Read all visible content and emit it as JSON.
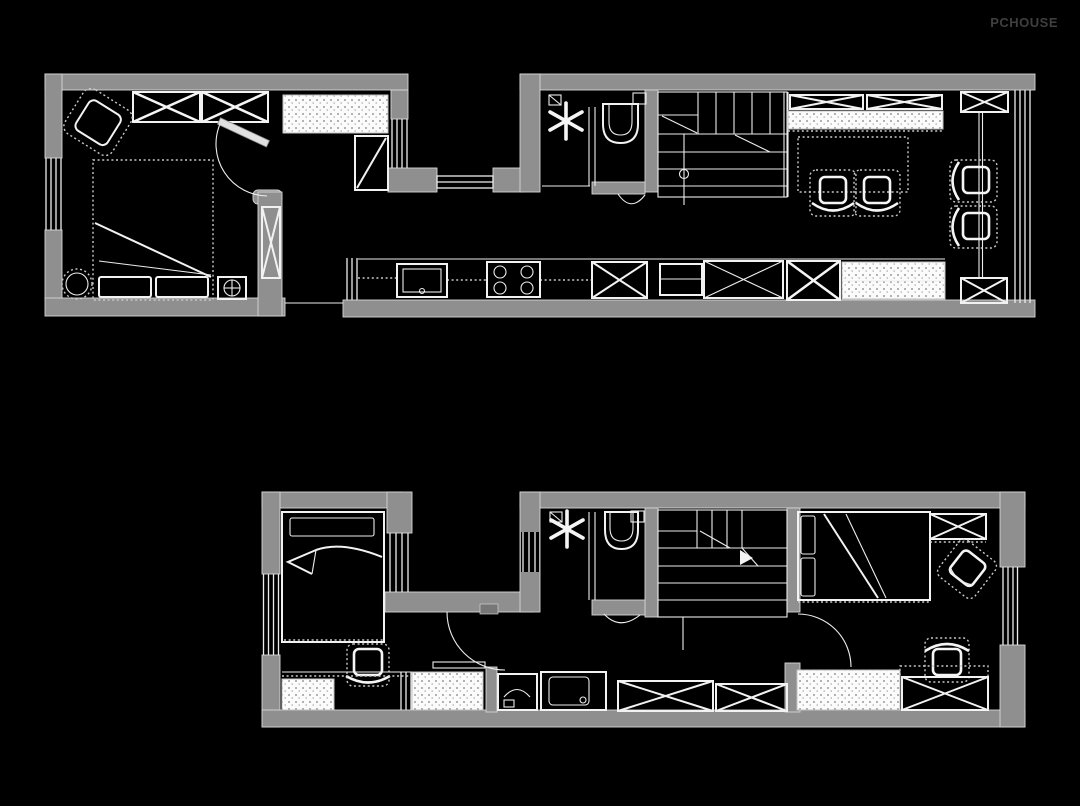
{
  "watermark": {
    "text": "PCHOUSE"
  },
  "colors": {
    "background": "#000000",
    "wall": "#8f8f8f",
    "furniture_line": "#f2f2f2",
    "dotted_line": "#c9c9c9",
    "watermark": "#3f3f3f"
  },
  "plans": [
    {
      "id": "upper-floor",
      "label": "Upper floor plan",
      "rooms": [
        "bedroom",
        "entry",
        "corridor",
        "bathroom",
        "staircase",
        "dining-area",
        "kitchen",
        "balcony"
      ],
      "furniture": [
        "wardrobe-x-cabinets",
        "lounge-cushion",
        "double-bed",
        "pillows",
        "round-side-table",
        "nightstand-with-lamp",
        "door-swing",
        "tall-x-cabinet",
        "shoe-cabinet-hatched",
        "mirror-cabinet",
        "floor-drain",
        "shower-head",
        "glass-partition",
        "toilet",
        "winder-staircase",
        "bench-hatched",
        "dining-table-dotted",
        "dining-chairs",
        "window-chairs",
        "sliding-partition",
        "kitchen-sink",
        "cooktop",
        "storage-x-cabinets",
        "long-hatched-cabinet"
      ]
    },
    {
      "id": "lower-floor",
      "label": "Lower floor plan",
      "rooms": [
        "bedroom",
        "hallway",
        "bathroom",
        "staircase",
        "second-bedroom",
        "study-corner",
        "laundry"
      ],
      "furniture": [
        "single-bed",
        "pillow",
        "blanket-fold",
        "desk-chair",
        "desk-hatched",
        "radiator-hatched",
        "door-swings",
        "laundry-sink",
        "washing-machine",
        "shower-head",
        "glass-partition",
        "toilet",
        "winder-staircase",
        "direction-arrow",
        "double-bed",
        "x-cabinet",
        "rotated-armchair",
        "study-desk-dotted",
        "study-chair",
        "rug-hatched",
        "storage-x-cabinets"
      ]
    }
  ]
}
